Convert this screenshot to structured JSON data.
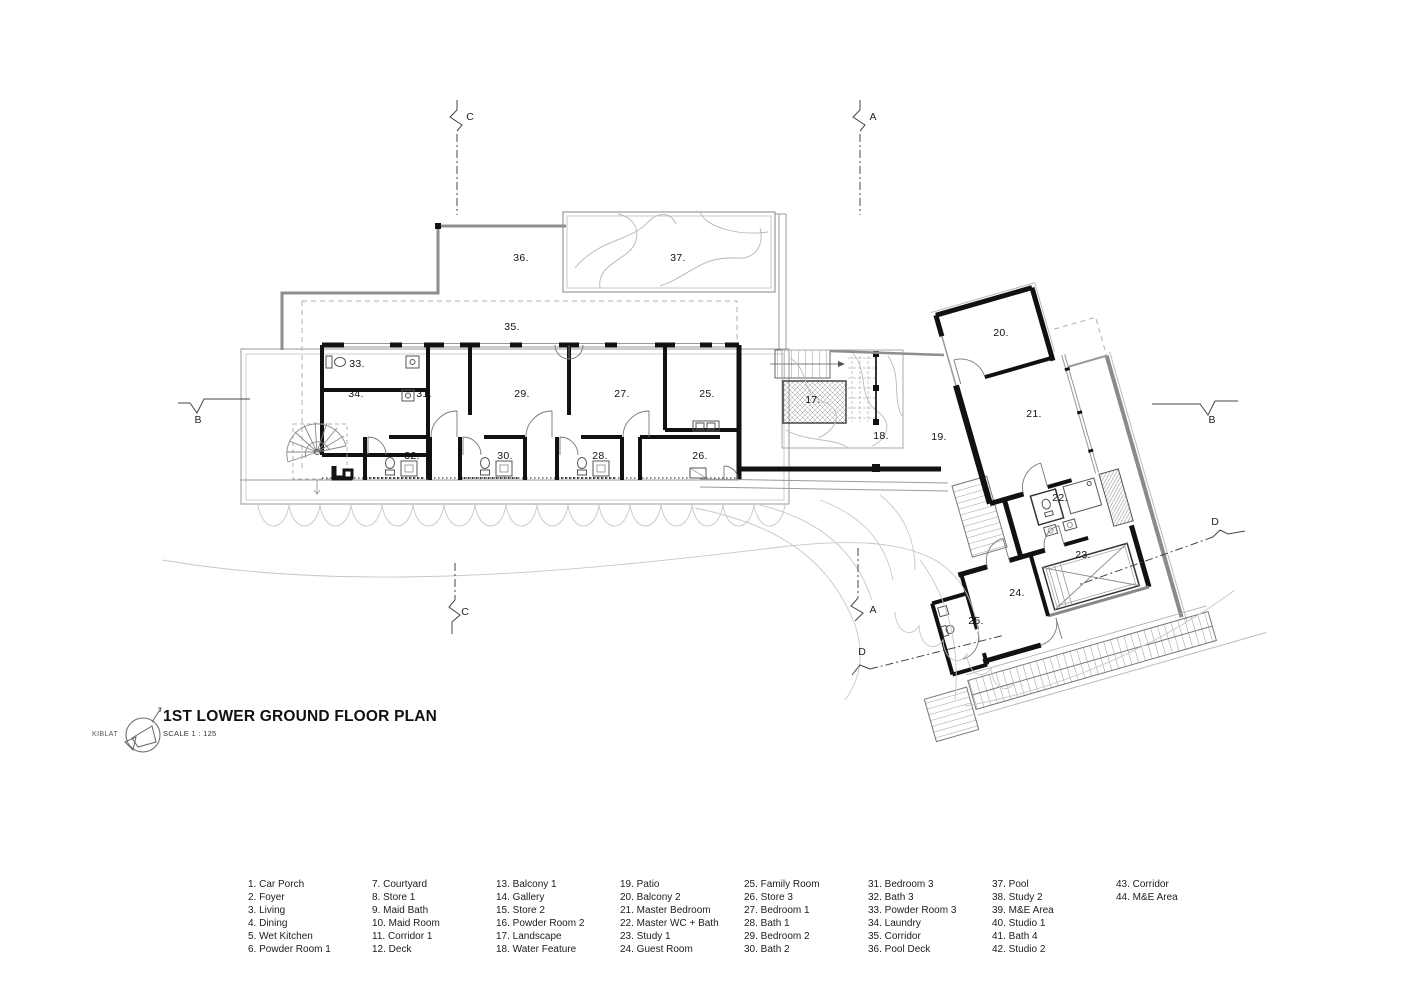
{
  "title_block": {
    "logo_text": "KIBLAT",
    "title": "1ST LOWER GROUND FLOOR PLAN",
    "scale_label": "SCALE 1 : 125"
  },
  "plan_labels": {
    "landscape": "17.",
    "water_feature": "18.",
    "patio": "19.",
    "balcony2": "20.",
    "master_bedroom": "21.",
    "master_wc_bath": "22.",
    "study1": "23.",
    "guest_room": "24.",
    "guest_bath": "25.",
    "family_room": "25.",
    "store3": "26.",
    "bedroom1": "27.",
    "bath1": "28.",
    "bedroom2": "29.",
    "bath2": "30.",
    "bedroom3": "31.",
    "bath3": "32.",
    "powder_room3": "33.",
    "laundry": "34.",
    "corridor": "35.",
    "pool_deck": "36.",
    "pool": "37."
  },
  "section_markers": {
    "a": "A",
    "b": "B",
    "c": "C",
    "d": "D"
  },
  "legend": {
    "columns": [
      {
        "items": [
          "1. Car Porch",
          "2. Foyer",
          "3. Living",
          "4. Dining",
          "5. Wet Kitchen",
          "6. Powder Room 1"
        ]
      },
      {
        "items": [
          "7. Courtyard",
          "8. Store 1",
          "9. Maid Bath",
          "10. Maid Room",
          "11. Corridor 1",
          "12. Deck"
        ]
      },
      {
        "items": [
          "13. Balcony 1",
          "14. Gallery",
          "15. Store 2",
          "16. Powder Room 2",
          "17. Landscape",
          "18. Water Feature"
        ]
      },
      {
        "items": [
          "19. Patio",
          "20. Balcony 2",
          "21. Master Bedroom",
          "22. Master WC + Bath",
          "23. Study 1",
          "24. Guest Room"
        ]
      },
      {
        "items": [
          "25. Family Room",
          "26. Store 3",
          "27. Bedroom 1",
          "28. Bath 1",
          "29. Bedroom 2",
          "30. Bath 2"
        ]
      },
      {
        "items": [
          "31. Bedroom 3",
          "32. Bath 3",
          "33. Powder Room 3",
          "34. Laundry",
          "35. Corridor",
          "36. Pool Deck"
        ]
      },
      {
        "items": [
          "37. Pool",
          "38. Study 2",
          "39. M&E Area",
          "40. Studio 1",
          "41. Bath 4",
          "42. Studio 2"
        ]
      },
      {
        "items": [
          "43. Corridor",
          "44. M&E Area"
        ]
      }
    ]
  }
}
